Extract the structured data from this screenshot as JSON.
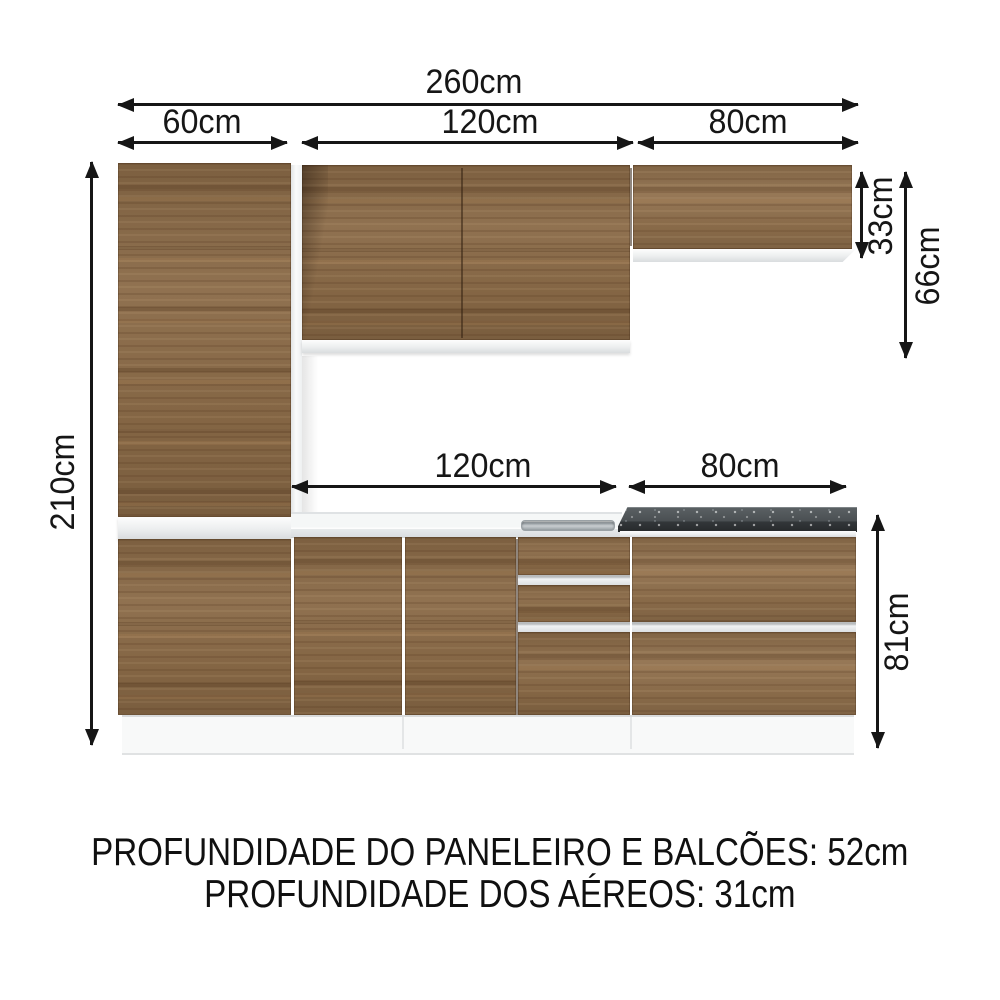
{
  "diagram": {
    "dimensions": {
      "total_width": "260cm",
      "tall_cabinet_width": "60cm",
      "upper_cabinet_width": "120cm",
      "upper_right_cabinet_width": "80cm",
      "counter_width": "120cm",
      "counter_right_width": "80cm",
      "total_height": "210cm",
      "upper_right_cabinet_height": "33cm",
      "upper_section_height": "66cm",
      "base_cabinet_height": "81cm"
    },
    "notes": {
      "line1": "PROFUNDIDADE DO PANELEIRO E BALCÕES: 52cm",
      "line2": "PROFUNDIDADE DOS AÉREOS: 31cm"
    },
    "colors": {
      "wood": "#8a6a47",
      "white_panel": "#f4f5f6",
      "granite_countertop": "#44484b",
      "arrow": "#161616",
      "background": "#ffffff"
    }
  }
}
